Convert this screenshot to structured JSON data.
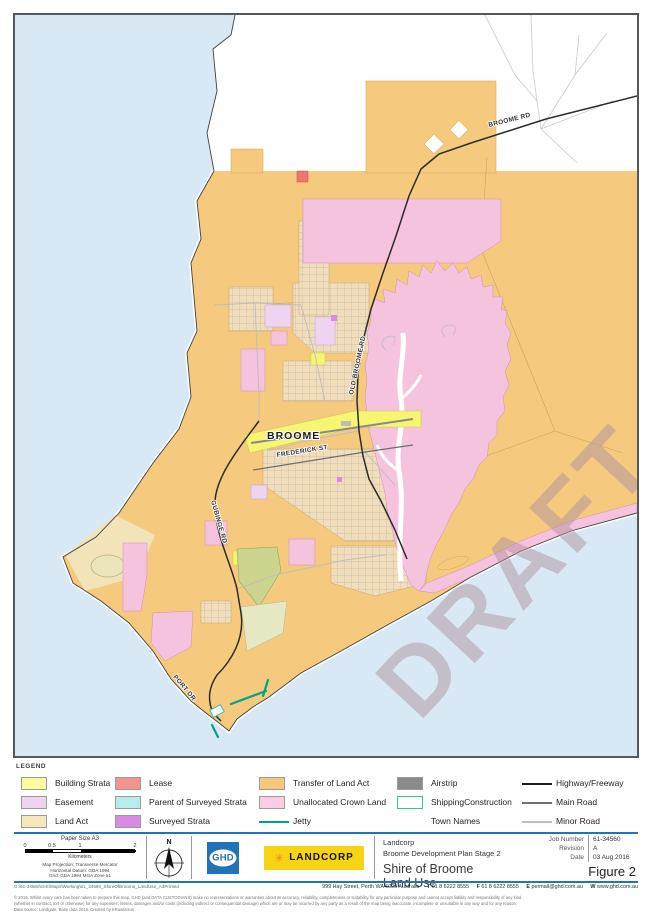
{
  "map": {
    "town_label": "BROOME",
    "watermark": "DRAFT",
    "road_labels": {
      "broome_rd": "BROOME RD",
      "old_broome_rd": "OLD BROOME RD",
      "frederick_st": "FREDERICK ST",
      "gubinge_rd": "GUBINGE RD",
      "port_dr": "PORT DR"
    },
    "colors": {
      "water": "#d8e9f5",
      "transfer_of_land_act": "#f5ca7e",
      "land_act": "#f3e3b8",
      "unallocated_crown_land": "#f6c3de",
      "building_strata": "#f8f573",
      "lease": "#e8635c",
      "jetty": "#00a388",
      "highway": "#2b2b2b",
      "olive_parcel": "#ccd38d"
    }
  },
  "legend": {
    "title": "LEGEND",
    "items": [
      {
        "label": "Building Strata",
        "color": "#fcfc9e"
      },
      {
        "label": "Lease",
        "color": "#f29490"
      },
      {
        "label": "Transfer of Land Act",
        "color": "#f6c87f"
      },
      {
        "label": "Airstrip",
        "color": "#8a8a8a"
      },
      {
        "label": "Highway/Freeway",
        "color": "#1c1c1c"
      },
      {
        "label": "Easement",
        "color": "#eed4f0"
      },
      {
        "label": "Parent of Surveyed Strata",
        "color": "#b7eceb"
      },
      {
        "label": "Unallocated Crown Land",
        "color": "#f9cbe5"
      },
      {
        "label": "ShippingConstruction",
        "color": "#ffffff",
        "border": "#33c1a0"
      },
      {
        "label": "Main Road",
        "color": "#707070"
      },
      {
        "label": "Land Act",
        "color": "#f6e6ba"
      },
      {
        "label": "Surveyed Strata",
        "color": "#da8ae3"
      },
      {
        "label": "Jetty",
        "color": "#00a388"
      },
      {
        "label": "Town Names"
      },
      {
        "label": "Minor Road",
        "color": "#bfbfbf"
      }
    ]
  },
  "titleblock": {
    "paper_size": "Paper Size A3",
    "scale_ticks": {
      "t0": "0",
      "t1": "0.5",
      "t2": "1",
      "t3": "2"
    },
    "scale_unit": "Kilometers",
    "projection_line1": "Map Projection: Transverse Mercator",
    "projection_line2": "Horizontal Datum:  GDA 1994",
    "projection_line3": "Grid: GDA 1994 MGA Zone 51",
    "north_label": "N",
    "ghd_logo_text": "GHD",
    "landcorp_logo_text": "LANDCORP",
    "client": "Landcorp",
    "project": "Broome Development Plan Stage 2",
    "title_line1": "Shire of Broome",
    "title_line2": "Land Use",
    "figure": "Figure 2",
    "job_number_label": "Job Number",
    "job_number": "61-34560",
    "revision_label": "Revision",
    "revision": "A",
    "date_label": "Date",
    "date": "03 Aug 2016"
  },
  "footer": {
    "path": "G:\\61-34560\\GIS\\Maps\\Working\\61_34560_ShireOfBroome_LandUse_A3Printed",
    "address": "999 Hay Street, Perth WA 6000 Australia",
    "phone_label": "T",
    "phone": "61 8 6222 8555",
    "fax_label": "F",
    "fax": "61 8 6222 8555",
    "email_label": "E",
    "email": "permail@ghd.com.au",
    "web_label": "W",
    "web": "www.ghd.com.au",
    "disclaimer_line1": "© 2016. Whilst every care has been taken to prepare this map, GHD (and DATA CUSTODIANS) make no representations or warranties about its accuracy, reliability, completeness or suitability for any particular purpose and cannot accept liability and responsibility of any kind",
    "disclaimer_line2": "(whether in contract, tort or otherwise) for any expenses, losses, damages and/or costs (including indirect or consequential damage) which are or may be incurred by any party as a result of the map being inaccurate, incomplete or unsuitable in any way and for any reason.",
    "disclaimer_line3": "Data source:  Landgate, Base data 2016.  Created by KRawlinson"
  }
}
